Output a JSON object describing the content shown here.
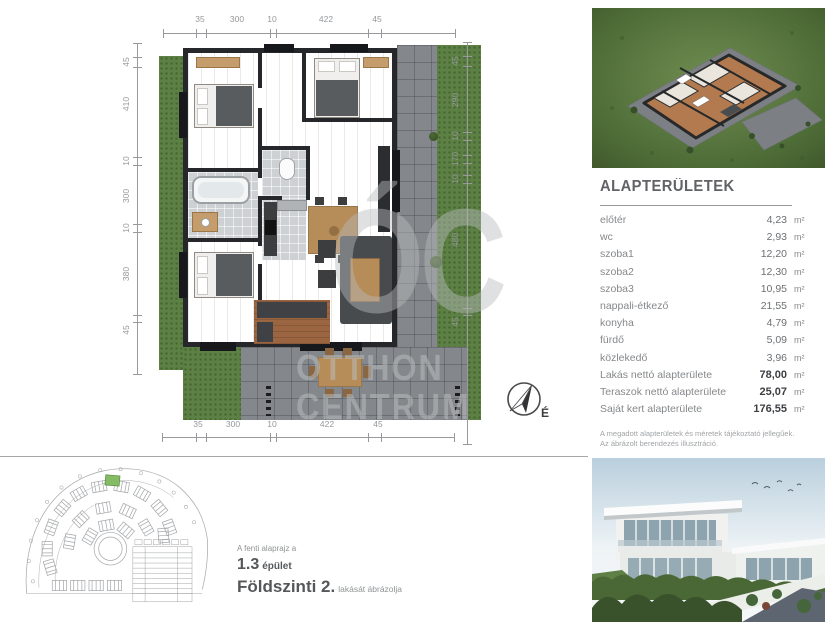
{
  "floor_plan": {
    "dims_top": [
      "35",
      "300",
      "10",
      "422",
      "45"
    ],
    "dims_bottom": [
      "35",
      "300",
      "10",
      "422",
      "45"
    ],
    "dims_left": [
      "45",
      "410",
      "10",
      "300",
      "10",
      "380",
      "45"
    ],
    "dims_right": [
      "45",
      "290",
      "10",
      "170",
      "10",
      "480",
      "45"
    ],
    "watermark": {
      "logo": "ÓC",
      "line1": "OTTHON",
      "line2": "CENTRUM"
    },
    "compass_label": "É"
  },
  "areas": {
    "title": "ALAPTERÜLETEK",
    "rows": [
      {
        "label": "előtér",
        "value": "4,23",
        "unit": "m²",
        "emphasis": false
      },
      {
        "label": "wc",
        "value": "2,93",
        "unit": "m²",
        "emphasis": false
      },
      {
        "label": "szoba1",
        "value": "12,20",
        "unit": "m²",
        "emphasis": false
      },
      {
        "label": "szoba2",
        "value": "12,30",
        "unit": "m²",
        "emphasis": false
      },
      {
        "label": "szoba3",
        "value": "10,95",
        "unit": "m²",
        "emphasis": false
      },
      {
        "label": "nappali-étkező",
        "value": "21,55",
        "unit": "m²",
        "emphasis": false
      },
      {
        "label": "konyha",
        "value": "4,79",
        "unit": "m²",
        "emphasis": false
      },
      {
        "label": "fürdő",
        "value": "5,09",
        "unit": "m²",
        "emphasis": false
      },
      {
        "label": "közlekedő",
        "value": "3,96",
        "unit": "m²",
        "emphasis": false
      },
      {
        "label": "Lakás nettó alapterülete",
        "value": "78,00",
        "unit": "m²",
        "emphasis": true
      },
      {
        "label": "Teraszok nettó alapterülete",
        "value": "25,07",
        "unit": "m²",
        "emphasis": true
      },
      {
        "label": "Saját kert alapterülete",
        "value": "176,55",
        "unit": "m²",
        "emphasis": true
      }
    ],
    "note_line1": "A megadott alapterületek és méretek tájékoztató jellegűek.",
    "note_line2": "Az ábrázolt berendezés illusztráció."
  },
  "caption": {
    "intro": "A fenti alaprajz a",
    "building_number": "1.3",
    "building_word": "épület",
    "floor_label": "Földszinti 2.",
    "floor_suffix": "lakását ábrázolja"
  },
  "colors": {
    "accent_green": "#5d8044",
    "wood": "#b07a50",
    "wall": "#26272a",
    "paving": "#84888c",
    "text_dark": "#55585b",
    "text_gray": "#8a8d90"
  }
}
